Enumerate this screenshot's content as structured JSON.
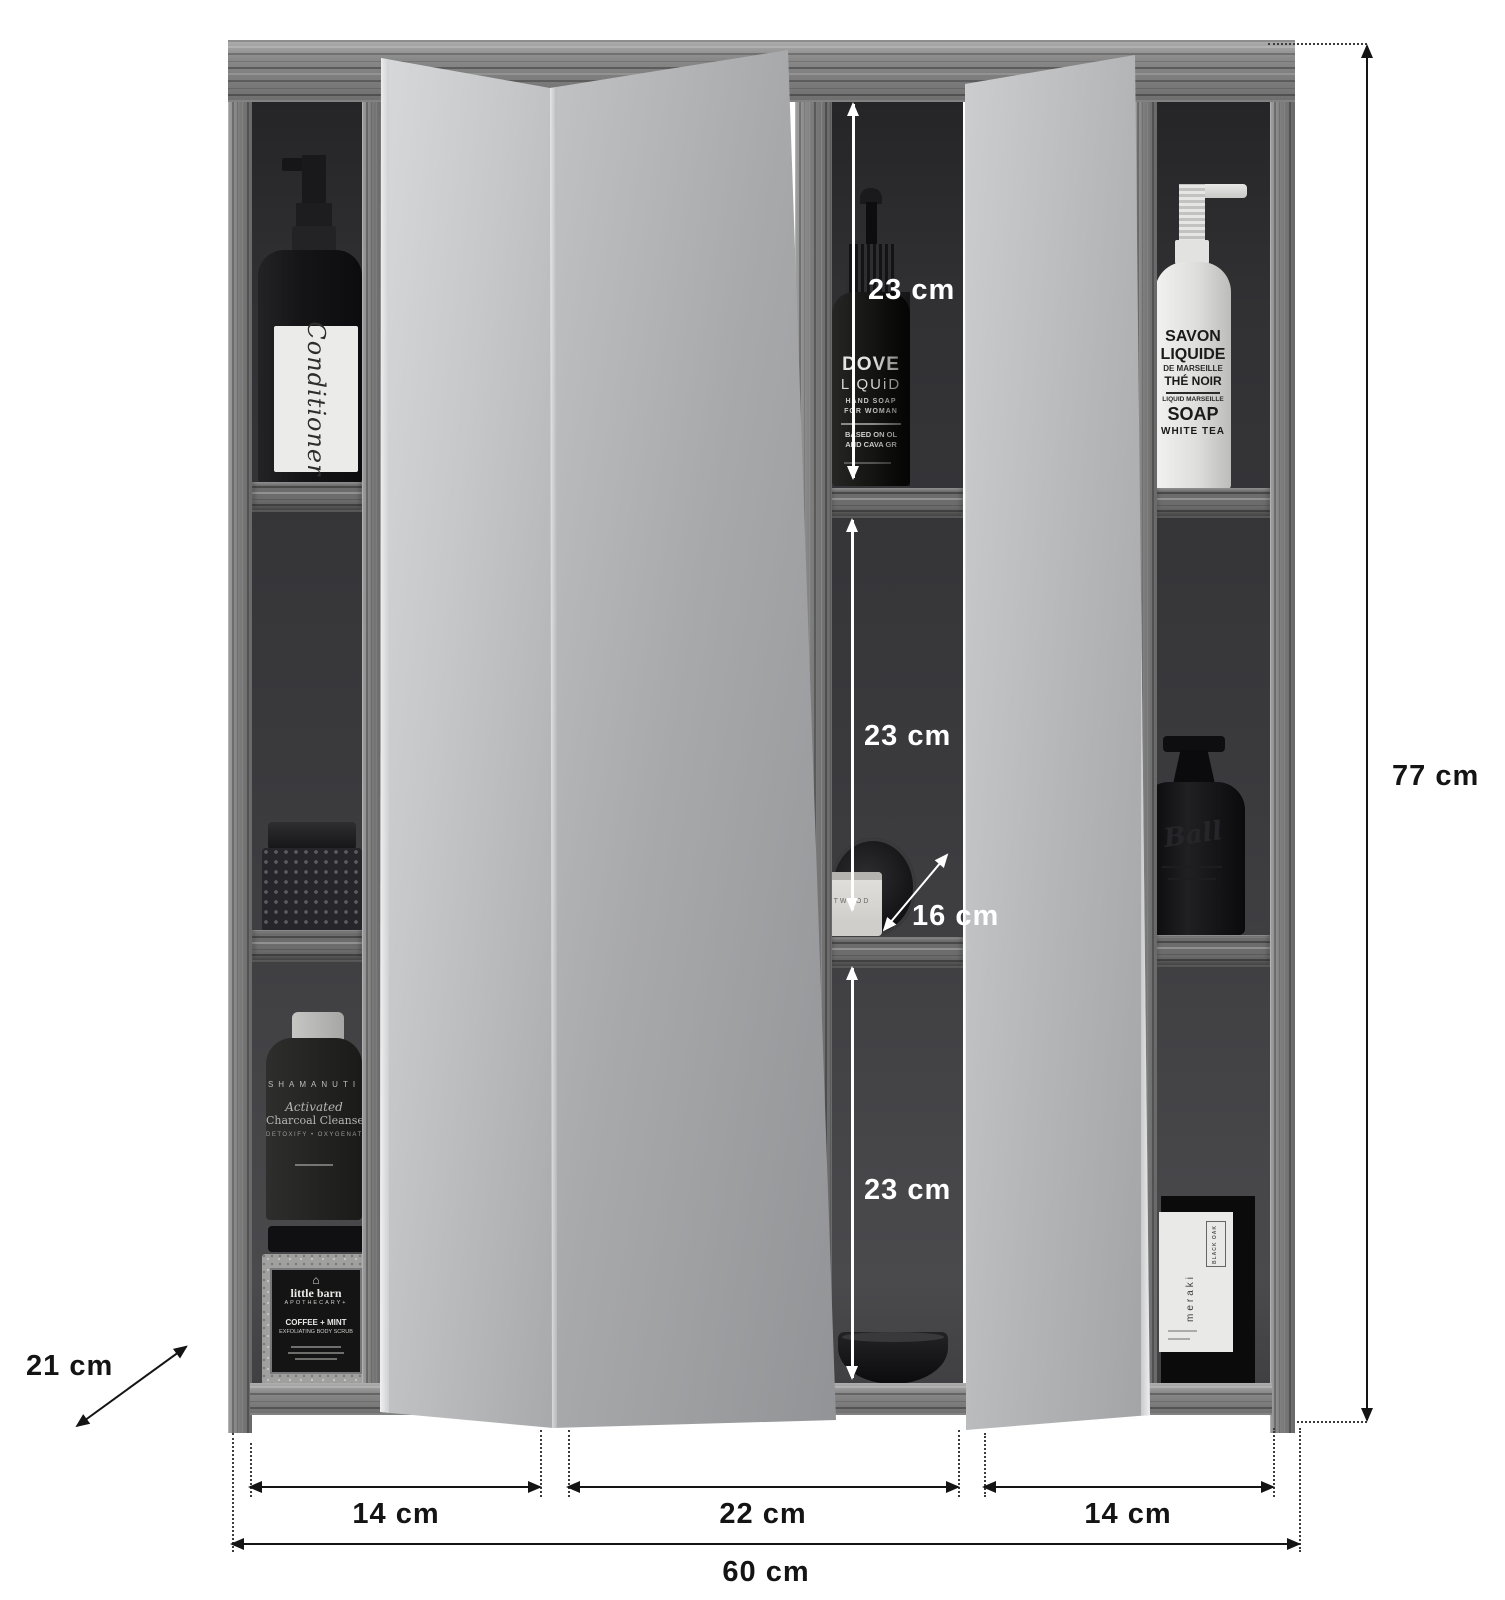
{
  "dimensions": {
    "total_height": "77 cm",
    "depth": "21 cm",
    "total_width": "60 cm",
    "door_left_width": "14 cm",
    "door_center_width": "22 cm",
    "door_right_width": "14 cm",
    "comp_top_height": "23 cm",
    "comp_mid_height": "23 cm",
    "comp_bottom_height": "23 cm",
    "shelf_depth": "16 cm"
  },
  "products": {
    "conditioner": {
      "name": "Conditioner"
    },
    "dover": {
      "line1": "DOVE",
      "line2": "LiQUiD",
      "line3": "HAND SOAP",
      "line4": "FOR WOMAN",
      "line5": "BASED ON OL",
      "line6": "AND CAVA GR"
    },
    "savon": {
      "line1": "SAVON",
      "line2": "LIQUIDE",
      "line3": "DE MARSEILLE",
      "line4": "THÉ NOIR",
      "line5": "LIQUID MARSEILLE",
      "line6": "SOAP",
      "line7": "WHITE TEA"
    },
    "shamanuti": {
      "line1": "SHAMANUTI",
      "line2": "Activated",
      "line3": "Charcoal Cleanser",
      "line4": "DETOXIFY • OXYGENATE"
    },
    "little_barn": {
      "icon": "⌂",
      "line1": "little barn",
      "line2": "APOTHECARY+",
      "line3": "COFFEE + MINT",
      "line4": "EXFOLIATING BODY SCRUB"
    },
    "twood": {
      "name": "TWOOD"
    },
    "ball": {
      "name": "Ball"
    },
    "meraki": {
      "brand": "meraki",
      "side": "BLACK OAK"
    }
  },
  "colors": {
    "annotation_black": "#141414",
    "annotation_white": "#ffffff",
    "wood_gray": "#8b8b8b",
    "interior_dark": "#3b3b3e",
    "mirror_gray": "#b0b1b3"
  }
}
